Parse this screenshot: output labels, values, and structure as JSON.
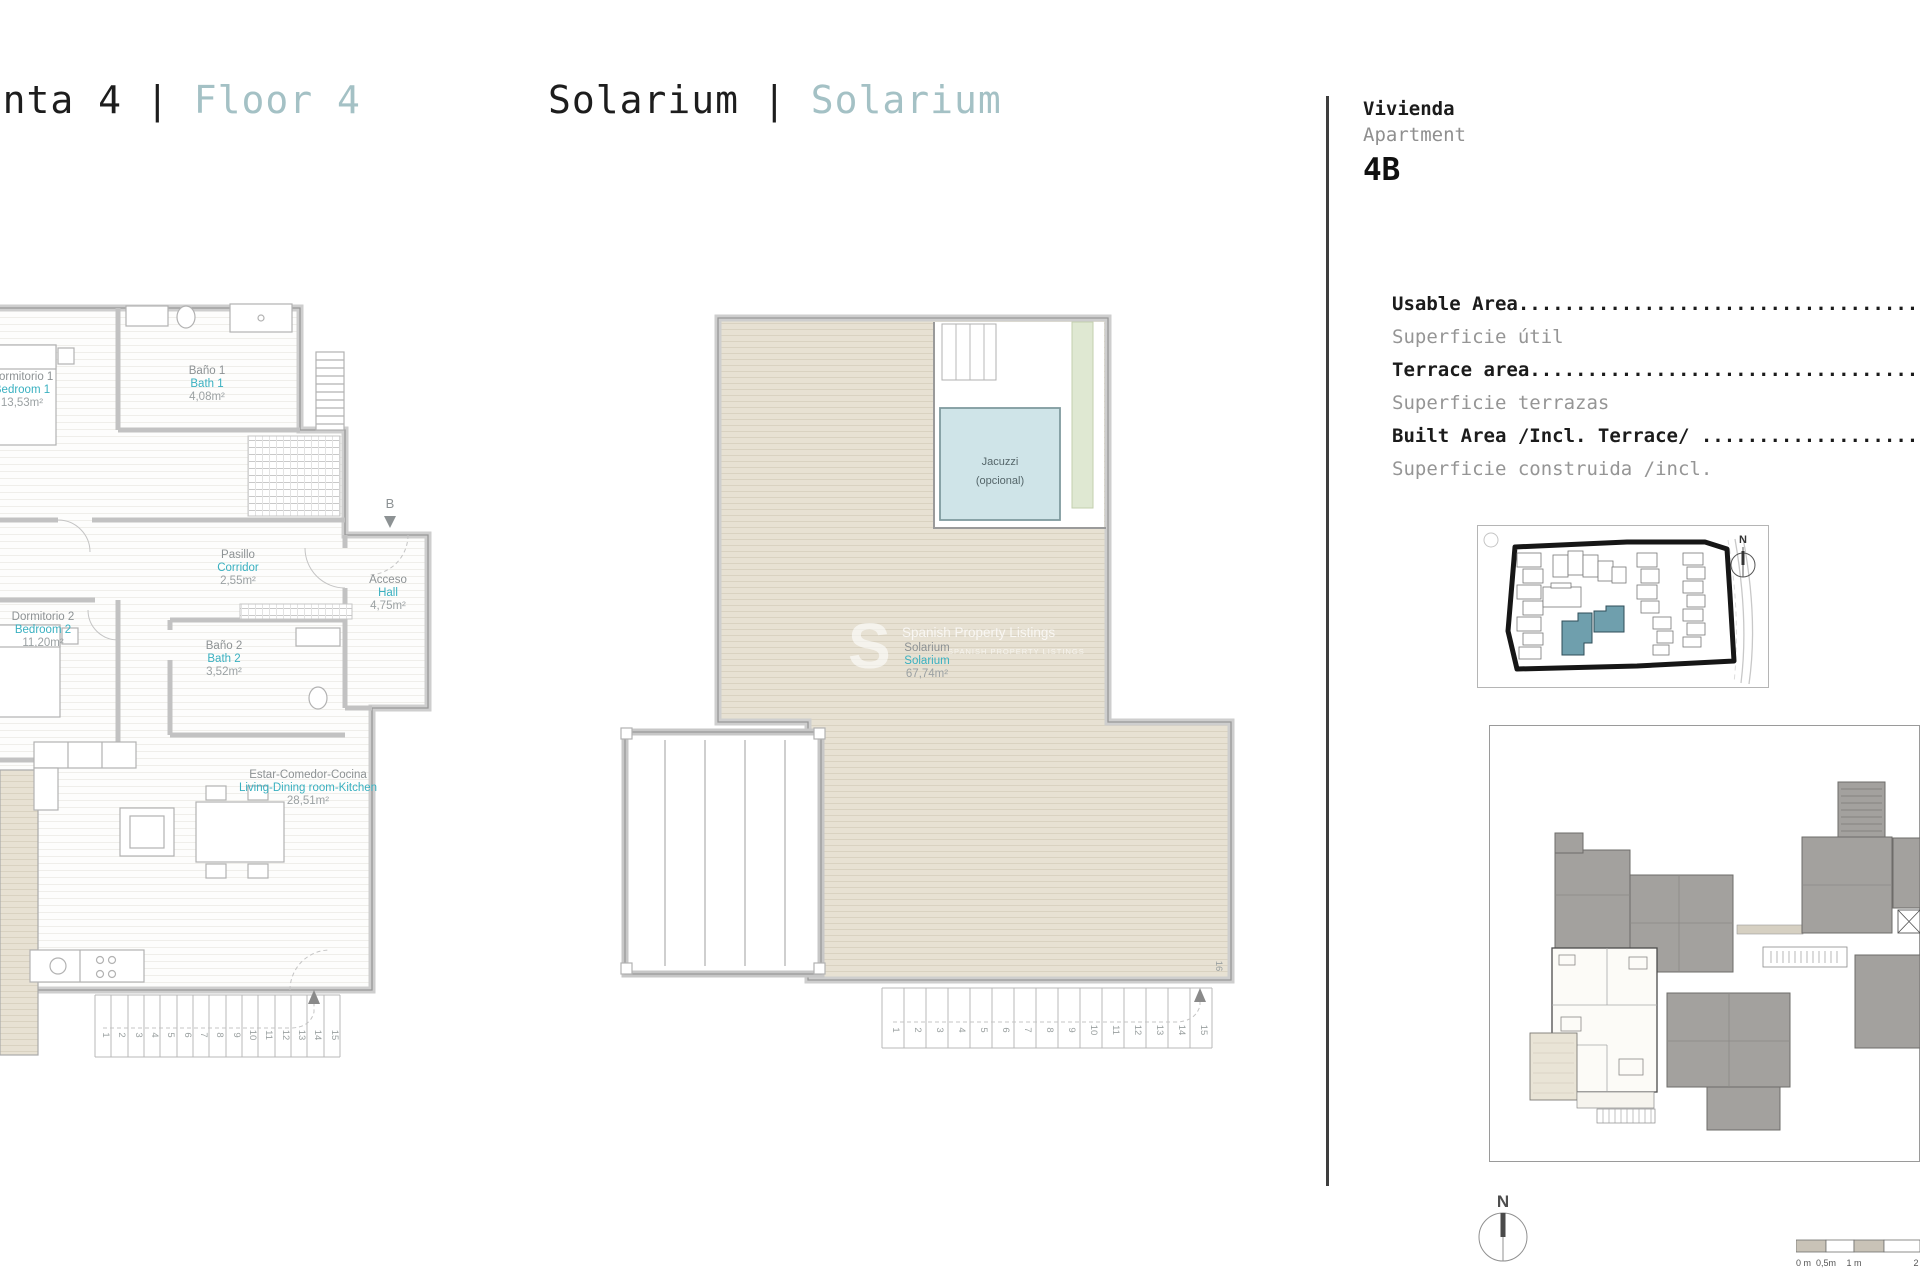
{
  "header": {
    "left": {
      "es": "Planta 4",
      "sep": "|",
      "en": "Floor 4"
    },
    "center": {
      "es": "Solarium",
      "sep": "|",
      "en": "Solarium"
    }
  },
  "info": {
    "vivienda": "Vivienda",
    "apartment": "Apartment",
    "unit": "4B",
    "rows": [
      {
        "en": "Usable Area.............................................",
        "es": "Superficie útil"
      },
      {
        "en": "Terrace area............................................",
        "es": "Superficie terrazas"
      },
      {
        "en": "Built Area /Incl. Terrace/ .............................",
        "es": "Superficie construida /incl."
      }
    ]
  },
  "plan_left": {
    "rooms": {
      "bedroom1": {
        "es": "Dormitorio 1",
        "en": "Bedroom 1",
        "area": "13,53m²"
      },
      "bath1": {
        "es": "Baño 1",
        "en": "Bath 1",
        "area": "4,08m²"
      },
      "corridor": {
        "es": "Pasillo",
        "en": "Corridor",
        "area": "2,55m²"
      },
      "hall": {
        "es": "Acceso",
        "en": "Hall",
        "area": "4,75m²"
      },
      "bedroom2": {
        "es": "Dormitorio 2",
        "en": "Bedroom 2",
        "area": "11,20m²"
      },
      "bath2": {
        "es": "Baño 2",
        "en": "Bath 2",
        "area": "3,52m²"
      },
      "living": {
        "es": "Estar-Comedor-Cocina",
        "en": "Living-Dining room-Kitchen",
        "area": "28,51m²"
      }
    },
    "section_marker": "B",
    "stairs": [
      "1",
      "2",
      "3",
      "4",
      "5",
      "6",
      "7",
      "8",
      "9",
      "10",
      "11",
      "12",
      "13",
      "14",
      "15"
    ]
  },
  "plan_solarium": {
    "room": {
      "es": "Solarium",
      "en": "Solarium",
      "area": "67,74m²"
    },
    "jacuzzi": {
      "line1": "Jacuzzi",
      "line2": "(opcional)"
    },
    "stairs": [
      "1",
      "2",
      "3",
      "4",
      "5",
      "6",
      "7",
      "8",
      "9",
      "10",
      "11",
      "12",
      "13",
      "14",
      "15"
    ],
    "top_step": "16"
  },
  "watermark": {
    "letter": "S",
    "line1": "Spanish Property Listings",
    "line2": "SPANISH PROPERTY LISTINGS"
  },
  "site_map": {
    "compass": "N"
  },
  "compass": {
    "label": "N"
  },
  "scale_bar": {
    "labels": [
      "0 m",
      "0,5m",
      "1 m",
      "2"
    ]
  }
}
